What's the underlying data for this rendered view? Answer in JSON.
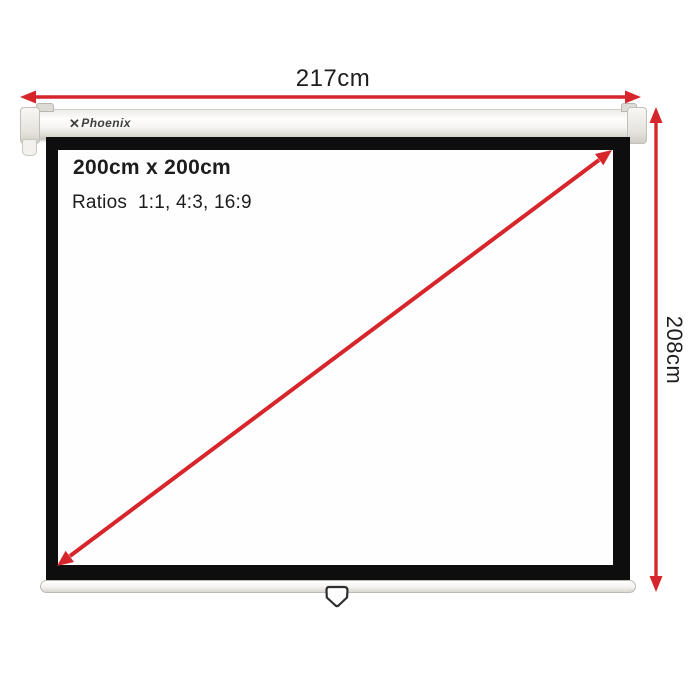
{
  "colors": {
    "red": "#d6252b",
    "frame": "#0e0e0e",
    "text": "#1d1d1d",
    "logo": "#3f3f3f"
  },
  "brand": {
    "glyph": "✕",
    "name": "Phoenix"
  },
  "annotations": {
    "width_label": "217cm",
    "height_label": "208cm",
    "diagonal_label": "112”"
  },
  "screen_info": {
    "size_label": "200cm x 200cm",
    "ratios_label": "Ratios  1:1, 4:3, 16:9"
  }
}
